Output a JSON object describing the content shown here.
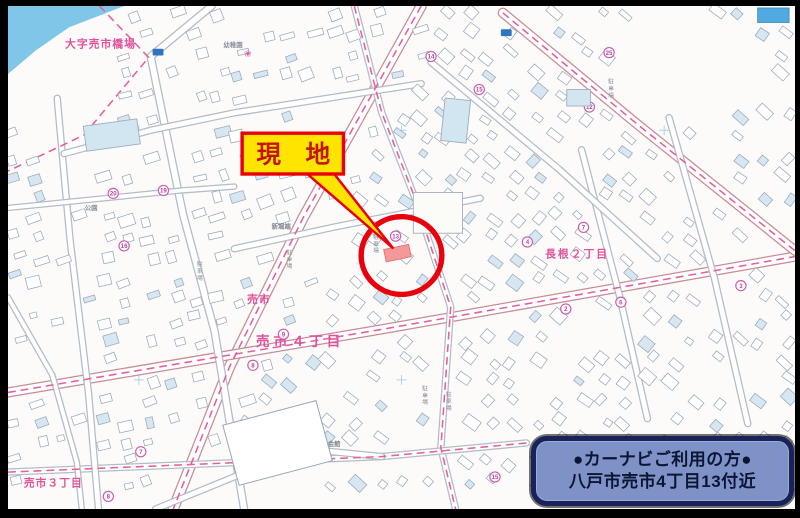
{
  "annotation": {
    "site_label": "現　地",
    "navi_box": {
      "line1": "●カーナビご利用の方●",
      "line2": "八戸市売市4丁目13付近"
    }
  },
  "colors": {
    "highlight_red": "#e8000c",
    "label_yellow": "#ffe400",
    "site_fill": "#f59898",
    "navi_fill": "#7f92c7",
    "navi_border": "#17235a",
    "map_pink": "#e0529c",
    "water_blue": "#7fc6e8"
  },
  "map": {
    "area_labels": [
      {
        "text": "大字売市橋場",
        "x": 58,
        "y": 43,
        "size": 11,
        "color": "#e0529c",
        "sp": 1
      },
      {
        "text": "売市",
        "x": 243,
        "y": 306,
        "size": 11,
        "color": "#e0529c",
        "sp": 1
      },
      {
        "text": "売市４丁目",
        "x": 252,
        "y": 350,
        "size": 14,
        "color": "#e0529c",
        "sp": 4
      },
      {
        "text": "長根２丁目",
        "x": 546,
        "y": 259,
        "size": 11,
        "color": "#e0529c",
        "sp": 2
      },
      {
        "text": "売市３丁目",
        "x": 16,
        "y": 495,
        "size": 11,
        "color": "#e0529c",
        "sp": 1
      },
      {
        "text": "売市公園",
        "x": 430,
        "y": 209,
        "size": 7,
        "color": "#cf6fa8",
        "sp": 0
      },
      {
        "text": "幼稚園",
        "x": 219,
        "y": 42,
        "size": 6.5,
        "color": "#8a8f98",
        "sp": 0
      },
      {
        "text": "マエダストア",
        "x": 246,
        "y": 451,
        "size": 6.5,
        "color": "#7d838d",
        "sp": 0
      },
      {
        "text": "売市店",
        "x": 253,
        "y": 459,
        "size": 6.5,
        "color": "#7d838d",
        "sp": 0
      },
      {
        "text": "新堀端",
        "x": 268,
        "y": 229,
        "size": 6.5,
        "color": "#7d838d",
        "sp": 0
      },
      {
        "text": "公園",
        "x": 78,
        "y": 210,
        "size": 6.5,
        "color": "#8a8f98",
        "sp": 0
      },
      {
        "text": "会館",
        "x": 325,
        "y": 453,
        "size": 6.5,
        "color": "#7d838d",
        "sp": 0
      }
    ],
    "parking_text": "駐車場",
    "parking_labels": [
      {
        "x": 371,
        "y": 240
      },
      {
        "x": 610,
        "y": 80
      },
      {
        "x": 283,
        "y": 256
      },
      {
        "x": 192,
        "y": 268
      },
      {
        "x": 445,
        "y": 402
      },
      {
        "x": 421,
        "y": 396
      }
    ],
    "circled_numbers": [
      {
        "n": "13",
        "x": 394,
        "y": 237
      },
      {
        "n": "4",
        "x": 528,
        "y": 243
      },
      {
        "n": "7",
        "x": 585,
        "y": 228
      },
      {
        "n": "2",
        "x": 567,
        "y": 312
      },
      {
        "n": "6",
        "x": 623,
        "y": 305
      },
      {
        "n": "3",
        "x": 745,
        "y": 288
      },
      {
        "n": "14",
        "x": 430,
        "y": 52
      },
      {
        "n": "15",
        "x": 479,
        "y": 86
      },
      {
        "n": "25",
        "x": 611,
        "y": 48
      },
      {
        "n": "12",
        "x": 591,
        "y": 104
      },
      {
        "n": "9",
        "x": 280,
        "y": 338
      },
      {
        "n": "8",
        "x": 249,
        "y": 370
      },
      {
        "n": "7",
        "x": 135,
        "y": 459
      },
      {
        "n": "8",
        "x": 102,
        "y": 505
      },
      {
        "n": "11",
        "x": 301,
        "y": 449
      },
      {
        "n": "15",
        "x": 495,
        "y": 485
      },
      {
        "n": "20",
        "x": 107,
        "y": 193
      },
      {
        "n": "19",
        "x": 158,
        "y": 190
      },
      {
        "n": "16",
        "x": 118,
        "y": 247
      }
    ]
  }
}
